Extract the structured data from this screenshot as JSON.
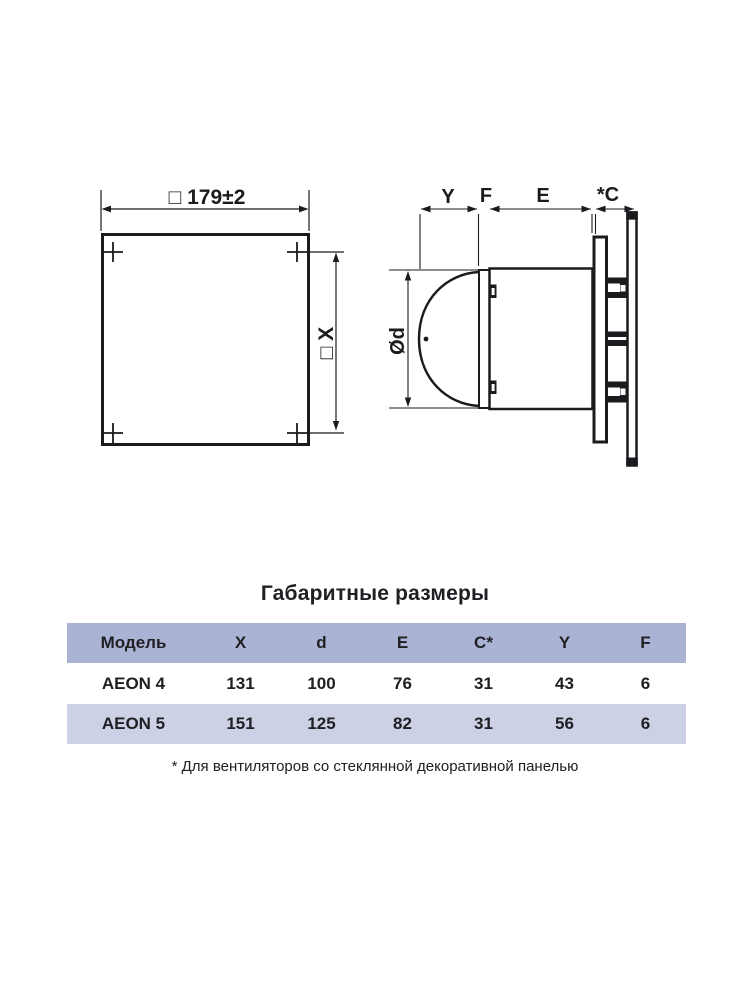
{
  "colors": {
    "ink": "#1b1b1f",
    "table_header_bg": "#aab3d4",
    "table_row_alt_bg": "#ccd1e6",
    "table_row_bg": "#ffffff",
    "text": "#202024"
  },
  "front_view": {
    "width_label": "□ 179±2",
    "height_label": "□ X"
  },
  "side_view": {
    "y_label": "Y",
    "f_label": "F",
    "e_label": "E",
    "c_label": "*C",
    "diameter_label": "Ød"
  },
  "dimensions_table": {
    "title": "Габаритные размеры",
    "headers": [
      "Модель",
      "X",
      "d",
      "E",
      "C*",
      "Y",
      "F"
    ],
    "rows": [
      {
        "model": "AEON 4",
        "x": "131",
        "d": "100",
        "e": "76",
        "c": "31",
        "y": "43",
        "f": "6"
      },
      {
        "model": "AEON 5",
        "x": "151",
        "d": "125",
        "e": "82",
        "c": "31",
        "y": "56",
        "f": "6"
      }
    ],
    "footnote": "* Для вентиляторов со стеклянной декоративной панелью"
  }
}
